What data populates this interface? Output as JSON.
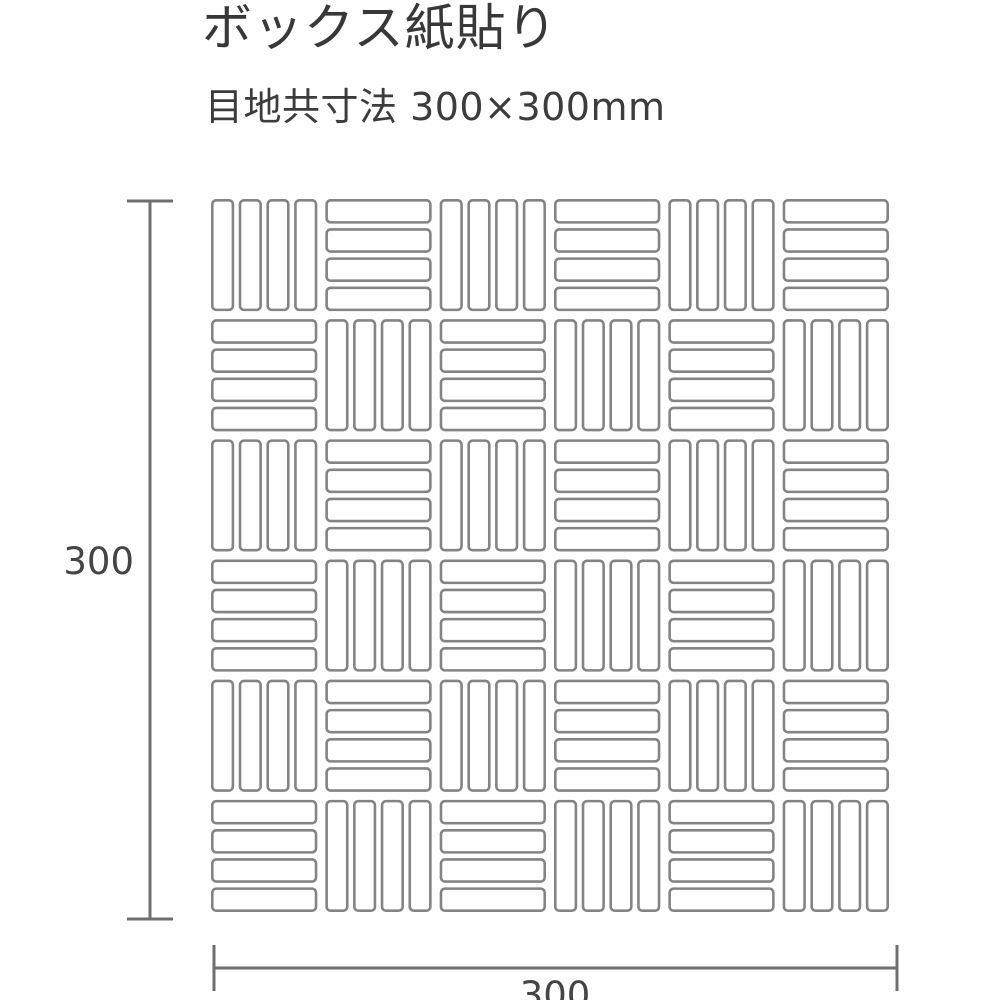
{
  "header": {
    "title": "ボックス紙貼り",
    "subtitle": "目地共寸法 300×300mm"
  },
  "diagram": {
    "height_dimension_label": "300",
    "width_dimension_label": "300",
    "colors": {
      "background": "#ffffff",
      "tile_fill": "#ffffff",
      "tile_stroke": "#848484",
      "dimension_line": "#6f6f6f",
      "text": "#3c3c3c"
    },
    "pattern": {
      "type": "basketweave-mosaic",
      "grid_rows": 6,
      "grid_cols": 6,
      "bars_per_block": 4,
      "first_block_orientation": "vertical",
      "alternation": "checkerboard"
    }
  }
}
